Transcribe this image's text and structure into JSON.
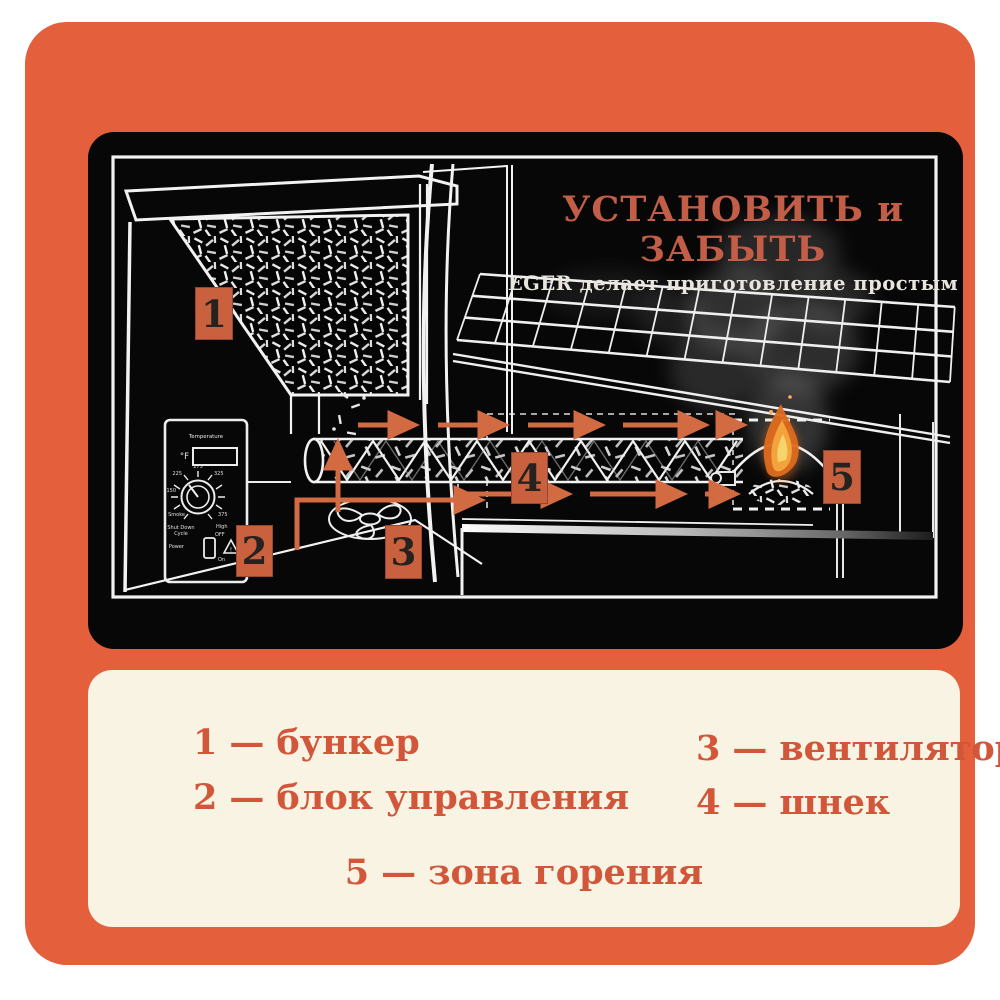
{
  "page": {
    "bg": "#ffffff",
    "card_bg": "#e45f3b",
    "panel_bg": "#070707",
    "legend_bg": "#f8f3e2",
    "accent_orange": "#d26a42"
  },
  "diagram": {
    "title": "УСТАНОВИТЬ и ЗАБЫТЬ",
    "subtitle": "EGER делает приготовление простым",
    "title_color": "#c25d48",
    "labels": {
      "n1": "1",
      "n2": "2",
      "n3": "3",
      "n4": "4",
      "n5": "5"
    },
    "control_panel": {
      "title": "Temperature",
      "unit": "°F",
      "marks": {
        "m150": "150",
        "m225": "225",
        "m275": "275",
        "m325": "325",
        "m375": "375",
        "smoke": "Smoke",
        "high": "High",
        "off": "OFF",
        "on": "On",
        "power": "Power",
        "shutdown": "Shut Down",
        "cycle": "Cycle",
        "warn": "!"
      }
    }
  },
  "legend": {
    "separator": "—",
    "text_color": "#d1563a",
    "items": [
      {
        "num": "1",
        "text": "бункер"
      },
      {
        "num": "2",
        "text": "блок управления"
      },
      {
        "num": "3",
        "text": "вентилятор"
      },
      {
        "num": "4",
        "text": "шнек"
      },
      {
        "num": "5",
        "text": "зона горения"
      }
    ]
  }
}
